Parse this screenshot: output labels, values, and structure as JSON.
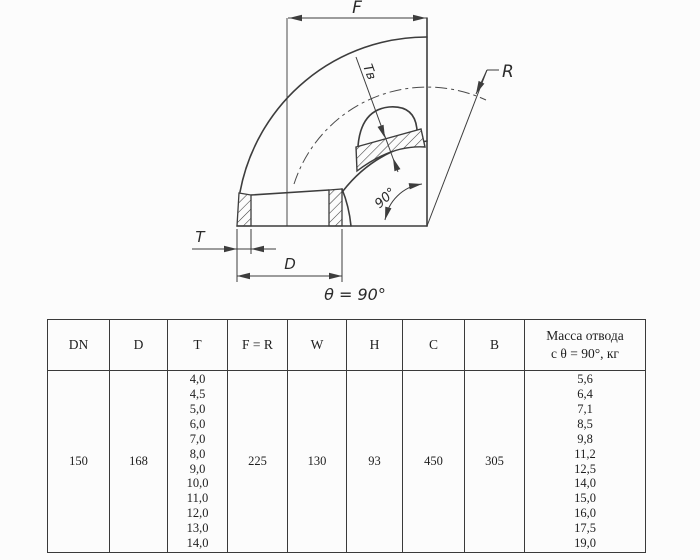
{
  "drawing": {
    "labels": {
      "f": "F",
      "r": "R",
      "tv": "Tв",
      "t": "T",
      "d": "D",
      "angle": "90°",
      "caption": "θ = 90°"
    },
    "line_color": "#3d3d3d"
  },
  "table": {
    "columns": [
      {
        "key": "dn",
        "label": "DN",
        "values": [
          "150"
        ]
      },
      {
        "key": "d",
        "label": "D",
        "values": [
          "168"
        ]
      },
      {
        "key": "t",
        "label": "T",
        "values": [
          "4,0",
          "4,5",
          "5,0",
          "6,0",
          "7,0",
          "8,0",
          "9,0",
          "10,0",
          "11,0",
          "12,0",
          "13,0",
          "14,0"
        ]
      },
      {
        "key": "f_r",
        "label": "F = R",
        "values": [
          "225"
        ]
      },
      {
        "key": "w",
        "label": "W",
        "values": [
          "130"
        ]
      },
      {
        "key": "h",
        "label": "H",
        "values": [
          "93"
        ]
      },
      {
        "key": "c",
        "label": "C",
        "values": [
          "450"
        ]
      },
      {
        "key": "b",
        "label": "B",
        "values": [
          "305"
        ]
      },
      {
        "key": "mass",
        "label": "Масса отвода\nс θ = 90°, кг",
        "values": [
          "5,6",
          "6,4",
          "7,1",
          "8,5",
          "9,8",
          "11,2",
          "12,5",
          "14,0",
          "15,0",
          "16,0",
          "17,5",
          "19,0"
        ]
      }
    ]
  }
}
